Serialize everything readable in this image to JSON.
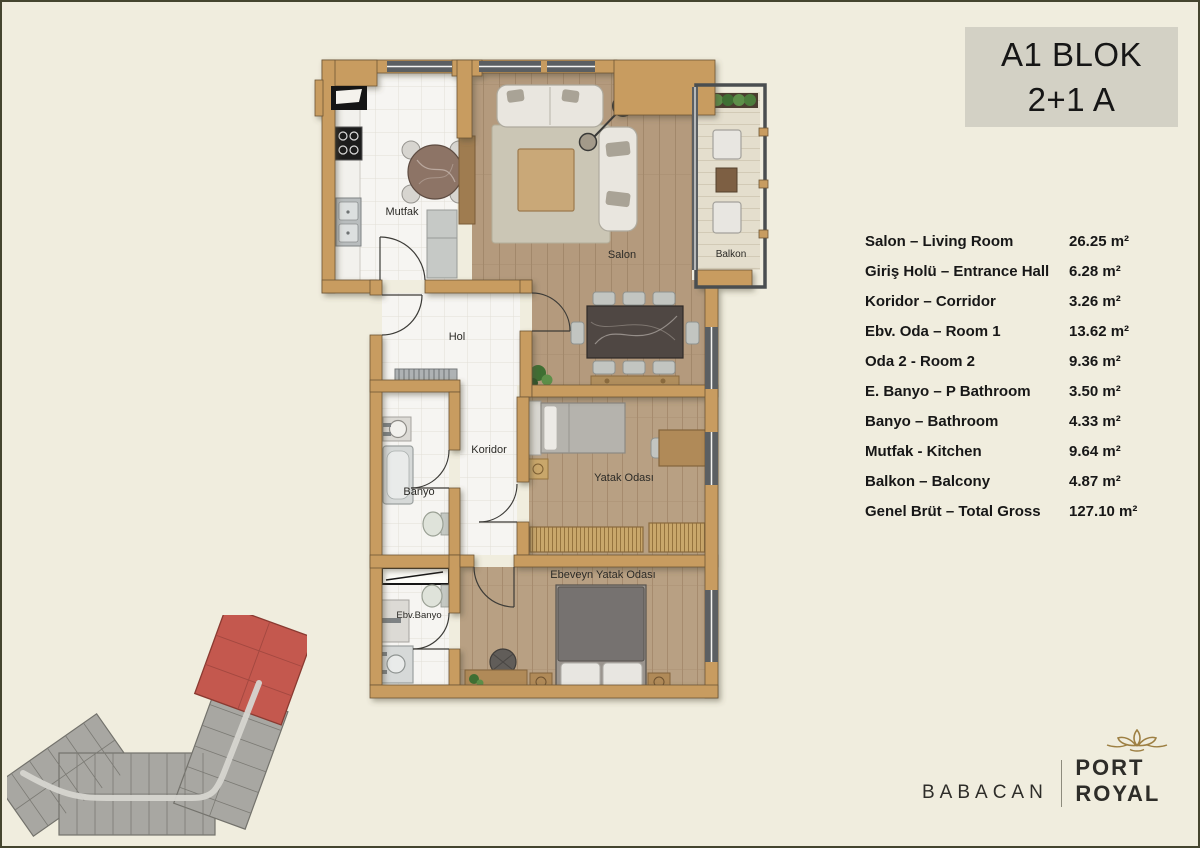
{
  "title": {
    "line1": "A1 BLOK",
    "line2": "2+1 A"
  },
  "legend": {
    "rows": [
      {
        "label": "Salon – Living Room",
        "area": "26.25 m²"
      },
      {
        "label": "Giriş Holü – Entrance Hall",
        "area": "6.28 m²"
      },
      {
        "label": "Koridor – Corridor",
        "area": "3.26 m²"
      },
      {
        "label": "Ebv. Oda – Room 1",
        "area": "13.62 m²"
      },
      {
        "label": "Oda 2  - Room 2",
        "area": "9.36 m²"
      },
      {
        "label": "E. Banyo – P Bathroom",
        "area": "3.50 m²"
      },
      {
        "label": "Banyo – Bathroom",
        "area": "4.33 m²"
      },
      {
        "label": "Mutfak - Kitchen",
        "area": "9.64 m²"
      },
      {
        "label": "Balkon – Balcony",
        "area": "4.87 m²"
      }
    ],
    "total": {
      "label": "Genel Brüt – Total Gross",
      "area": "127.10 m²"
    }
  },
  "plan": {
    "rooms": {
      "mutfak": "Mutfak",
      "salon": "Salon",
      "balkon": "Balkon",
      "hol": "Hol",
      "koridor": "Koridor",
      "banyo": "Banyo",
      "yatak": "Yatak Odası",
      "ebv_banyo": "Ebv.Banyo",
      "ebeveyn": "Ebeveyn Yatak Odası"
    }
  },
  "brand": {
    "company": "BABACAN",
    "project": "PORT ROYAL"
  },
  "colors": {
    "background": "#f0edde",
    "wall": "#c89c60",
    "title_bg": "#d3d1c5",
    "highlight": "#c4584e",
    "gold": "#9d7f42"
  }
}
